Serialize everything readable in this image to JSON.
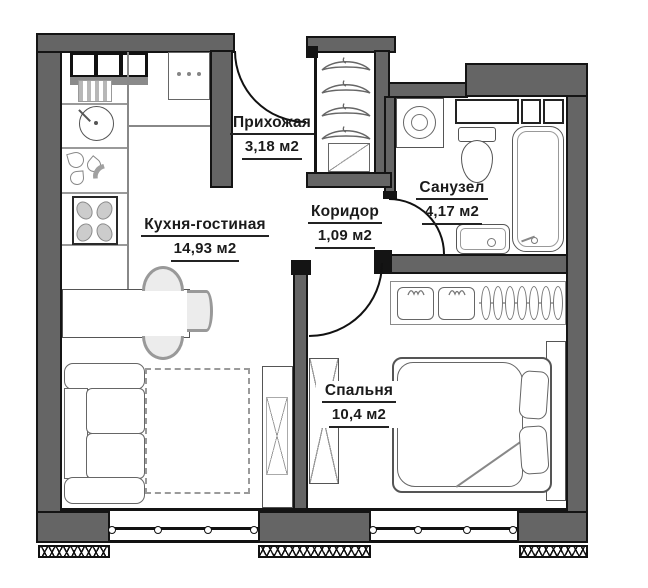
{
  "plan": {
    "type": "apartment-floor-plan",
    "units": "м2",
    "colors": {
      "wall_fill": "#656565",
      "wall_outline": "#141414",
      "line": "#555555",
      "background": "#ffffff"
    },
    "rooms": [
      {
        "id": "hallway",
        "label": "Прихожая",
        "area": "3,18 м2"
      },
      {
        "id": "kitchen_living",
        "label": "Кухня-гостиная",
        "area": "14,93 м2"
      },
      {
        "id": "corridor",
        "label": "Коридор",
        "area": "1,09 м2"
      },
      {
        "id": "bathroom",
        "label": "Санузел",
        "area": "4,17 м2"
      },
      {
        "id": "bedroom",
        "label": "Спальня",
        "area": "10,4 м2"
      }
    ],
    "icons": {
      "hanger-icon": "svg-arc-with-hook",
      "stove-icon": "box-with-4-oval-burners",
      "kitchen-sink-icon": "circle-with-tap",
      "washing-machine-icon": "box-with-double-circle",
      "toilet-icon": "tank-plus-oval-bowl",
      "bathtub-icon": "rounded-rect-with-inner-line",
      "bathroom-sink-icon": "rounded-square-with-drain",
      "bed-icon": "mattress-blanket-two-pillows",
      "sofa-icon": "armrests-back-two-cushions",
      "dining-table-icon": "rect-with-three-chair-arcs",
      "wardrobe-icon": "rect-with-x-cross",
      "window-icon": "double-line-with-circles",
      "door-swing-icon": "quarter-circle-arc"
    }
  }
}
